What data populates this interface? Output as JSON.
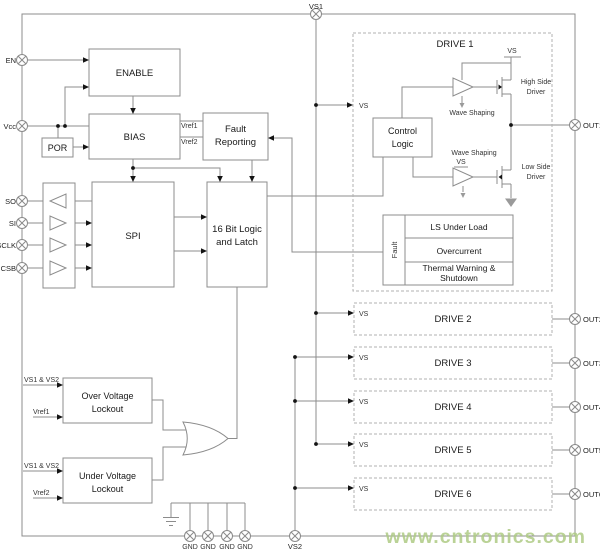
{
  "pins": {
    "vs1": "VS1",
    "vs2": "VS2",
    "en": "EN",
    "vcc": "Vcc",
    "so": "SO",
    "si": "SI",
    "sclk": "SCLK",
    "csb": "CSB",
    "gnd1": "GND",
    "gnd2": "GND",
    "gnd3": "GND",
    "gnd4": "GND",
    "out1": "OUT1",
    "out2": "OUT2",
    "out3": "OUT3",
    "out4": "OUT4",
    "out5": "OUT5",
    "out6": "OUT6"
  },
  "blocks": {
    "enable": "ENABLE",
    "bias": "BIAS",
    "por": "POR",
    "fault_reporting_1": "Fault",
    "fault_reporting_2": "Reporting",
    "spi": "SPI",
    "logic_1": "16 Bit Logic",
    "logic_2": "and Latch",
    "control_1": "Control",
    "control_2": "Logic",
    "ovl_1": "Over Voltage",
    "ovl_2": "Lockout",
    "uvl_1": "Under Voltage",
    "uvl_2": "Lockout"
  },
  "fault": {
    "side": "Fault",
    "row1": "LS Under Load",
    "row2": "Overcurrent",
    "row3a": "Thermal Warning &",
    "row3b": "Shutdown"
  },
  "drives": {
    "d1": "DRIVE 1",
    "d2": "DRIVE 2",
    "d3": "DRIVE 3",
    "d4": "DRIVE 4",
    "d5": "DRIVE 5",
    "d6": "DRIVE 6"
  },
  "labels": {
    "vs": "VS",
    "vref1": "Vref1",
    "vref2": "Vref2",
    "vs1_vs2": "VS1 & VS2",
    "wave_shaping": "Wave Shaping",
    "high_side_1": "High Side",
    "high_side_2": "Driver",
    "low_side_1": "Low Side",
    "low_side_2": "Driver"
  },
  "watermark": {
    "text": "www.cntronics.com"
  },
  "colors": {
    "line": "#8c8c8c",
    "dashed_border": "#b2b2b2",
    "arrow": "#141414",
    "watermark_green": "#aecb84",
    "background": "#ffffff"
  }
}
